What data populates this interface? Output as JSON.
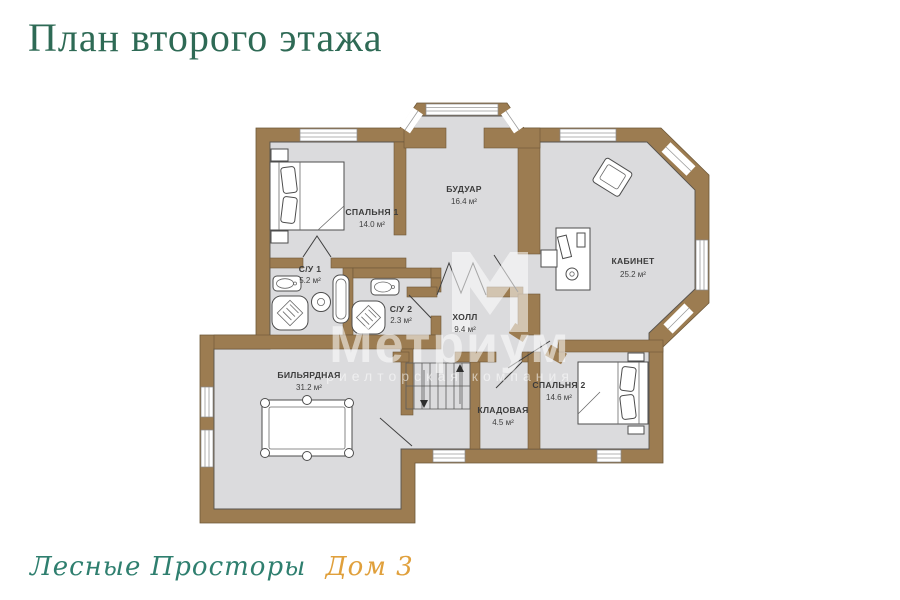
{
  "page": {
    "title": "План второго этажа"
  },
  "watermark": {
    "brand": "Метриум",
    "tagline": "риелторская компания"
  },
  "footer": {
    "project": "Лесные Просторы",
    "house": "Дом 3"
  },
  "colors": {
    "wall": "#9c7c51",
    "floor": "#dbdbdd",
    "title_green": "#2e6a55",
    "script_teal": "#2f7f6f",
    "script_orange": "#e0a03c"
  },
  "rooms": [
    {
      "name": "СПАЛЬНЯ 1",
      "area": "14.0 м²"
    },
    {
      "name": "БУДУАР",
      "area": "16.4 м²"
    },
    {
      "name": "КАБИНЕТ",
      "area": "25.2 м²"
    },
    {
      "name": "С/У 1",
      "area": "5.2 м²"
    },
    {
      "name": "С/У 2",
      "area": "2.3 м²"
    },
    {
      "name": "ХОЛЛ",
      "area": "9.4 м²"
    },
    {
      "name": "БИЛЬЯРДНАЯ",
      "area": "31.2 м²"
    },
    {
      "name": "КЛАДОВАЯ",
      "area": "4.5 м²"
    },
    {
      "name": "СПАЛЬНЯ 2",
      "area": "14.6 м²"
    }
  ]
}
